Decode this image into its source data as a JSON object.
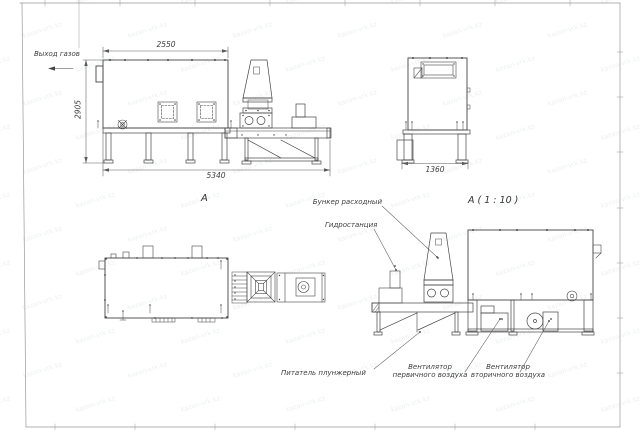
{
  "watermark": {
    "text": "kazan-vrk.kz"
  },
  "callouts": {
    "gas_outlet": "Выход газов",
    "bunker": "Бункер расходный",
    "hydro": "Гидростанция",
    "feeder": "Питатель плунжерный",
    "fan_primary_line1": "Вентилятор",
    "fan_primary_line2": "первичного воздуха",
    "fan_secondary_line1": "Вентилятор",
    "fan_secondary_line2": "вторичного воздуха"
  },
  "dimensions": {
    "front_width_top": "2550",
    "front_height": "2905",
    "front_width_total": "5340",
    "side_width": "1360"
  },
  "view_labels": {
    "front": "А",
    "side_scaled": "А ( 1 : 10 )"
  },
  "colors": {
    "line": "#454545",
    "thin_line": "#5a5a5a",
    "frame": "#8f8f8f",
    "background": "#ffffff",
    "watermark": "#8fa0a8"
  }
}
